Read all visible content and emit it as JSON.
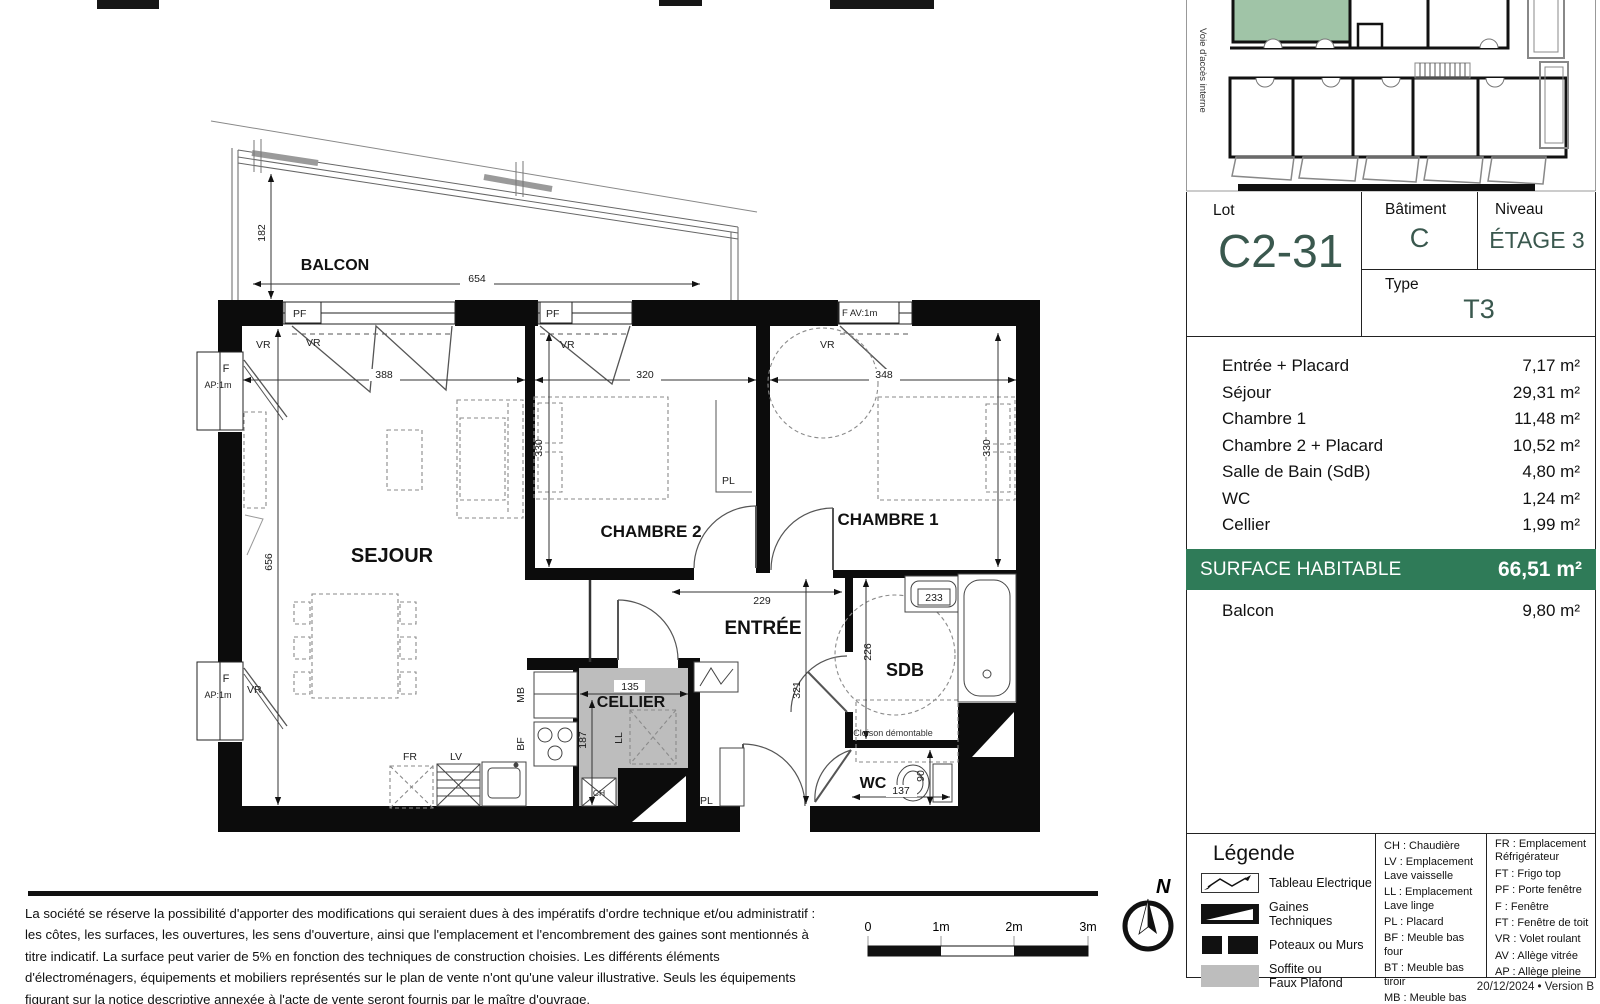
{
  "colors": {
    "accent_green": "#2f7b58",
    "value_teal": "#3a584e",
    "keyplan_highlight": "#a0c4a7",
    "soffite_gray": "#bdbdbd"
  },
  "keyplan": {
    "access_label": "Voie d'accès interne"
  },
  "title_block": {
    "lot_label": "Lot",
    "lot_value": "C2-31",
    "batiment_label": "Bâtiment",
    "batiment_value": "C",
    "niveau_label": "Niveau",
    "niveau_value": "ÉTAGE 3",
    "type_label": "Type",
    "type_value": "T3"
  },
  "areas": {
    "rows": [
      {
        "label": "Entrée + Placard",
        "value": "7,17 m²"
      },
      {
        "label": "Séjour",
        "value": "29,31 m²"
      },
      {
        "label": "Chambre 1",
        "value": "11,48 m²"
      },
      {
        "label": "Chambre 2 + Placard",
        "value": "10,52 m²"
      },
      {
        "label": "Salle de Bain (SdB)",
        "value": "4,80 m²"
      },
      {
        "label": "WC",
        "value": "1,24 m²"
      },
      {
        "label": "Cellier",
        "value": "1,99 m²"
      }
    ],
    "surface_label": "SURFACE HABITABLE",
    "surface_value": "66,51 m²",
    "balcon_label": "Balcon",
    "balcon_value": "9,80 m²"
  },
  "plan": {
    "rooms": {
      "balcon": "BALCON",
      "sejour": "SEJOUR",
      "chambre2": "CHAMBRE 2",
      "chambre1": "CHAMBRE 1",
      "entree": "ENTRÉE",
      "cellier": "CELLIER",
      "sdb": "SDB",
      "wc": "WC"
    },
    "tags": {
      "pf": "PF",
      "f_av": "F AV:1m",
      "f": "F",
      "ap": "AP:1m",
      "vr": "VR",
      "pl": "PL",
      "ll": "LL",
      "ch": "CH",
      "mb": "MB",
      "bf": "BF",
      "fr": "FR",
      "lv": "LV",
      "cloison": "Cloison démontable"
    },
    "dims": {
      "balcon_w": "654",
      "balcon_d": "182",
      "sejour_w": "388",
      "sejour_h": "656",
      "ch2_w": "320",
      "ch2_h": "330",
      "ch1_w": "348",
      "ch1_h": "330",
      "entree_w": "229",
      "entree_h": "321",
      "cellier_w": "135",
      "cellier_h": "187",
      "sdb_h": "226",
      "sdb_w": "233",
      "wc_w": "137",
      "wc_h": "90"
    }
  },
  "legend": {
    "title": "Légende",
    "symbols": [
      {
        "label": "Tableau Electrique"
      },
      {
        "label": "Gaines Techniques"
      },
      {
        "label": "Poteaux ou Murs"
      },
      {
        "label": "Soffite ou\nFaux Plafond"
      }
    ],
    "col2": [
      "CH : Chaudière",
      "LV : Emplacement\nLave vaisselle",
      "LL : Emplacement\nLave linge",
      "PL : Placard",
      "BF : Meuble bas four",
      "BT : Meuble bas tiroir",
      "MB : Meuble bas"
    ],
    "col3": [
      "FR : Emplacement\nRéfrigérateur",
      "FT : Frigo top",
      "PF : Porte fenêtre",
      "F : Fenêtre",
      "FT : Fenêtre de toit",
      "VR : Volet roulant",
      "AV : Allège vitrée",
      "AP : Allège pleine"
    ]
  },
  "footer": {
    "disclaimer": "La société se réserve la possibilité d'apporter des modifications qui seraient dues à des impératifs d'ordre technique et/ou administratif : les côtes, les surfaces, les ouvertures, les sens d'ouverture, ainsi que l'emplacement et l'encombrement des gaines sont mentionnés à titre indicatif. La surface peut varier de 5% en fonction des techniques de construction choisies. Les différents éléments d'électroménagers, équipements et mobiliers représentés sur le plan de vente n'ont qu'une valeur illustrative. Seuls les équipements figurant sur la notice descriptive annexée à l'acte de vente seront fournis par le maître d'ouvrage.",
    "scale": [
      "0",
      "1m",
      "2m",
      "3m"
    ],
    "north": "N",
    "version": "20/12/2024 • Version B"
  }
}
